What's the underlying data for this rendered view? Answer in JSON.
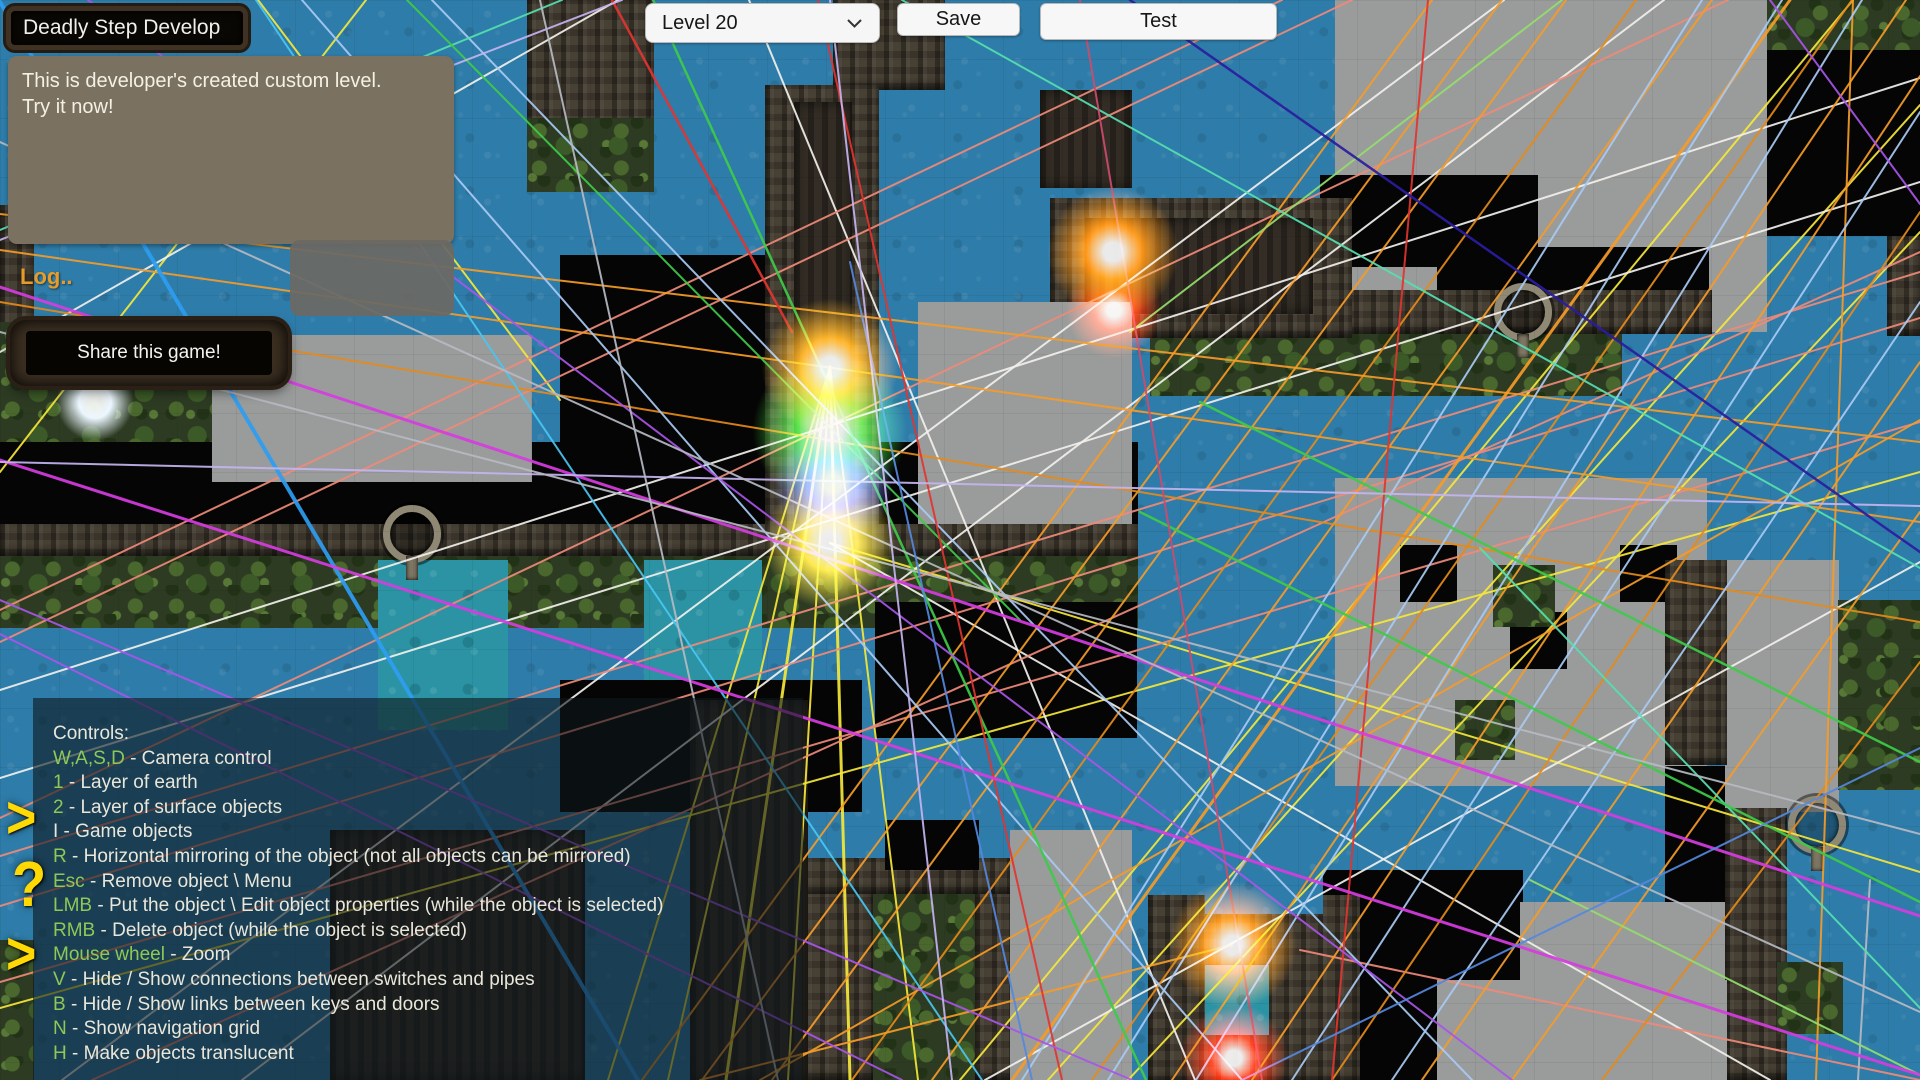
{
  "ui": {
    "title": "Deadly Step Develop",
    "description_line1": "This is developer's created custom level.",
    "description_line2": "Try it now!",
    "log_label": "Log..",
    "share_label": "Share this game!",
    "level_select": {
      "value": "Level 20"
    },
    "save_label": "Save",
    "test_label": "Test",
    "colors": {
      "key_green": "#8dc957",
      "key_white": "#e9e6da",
      "log_orange": "#e79b28",
      "glyph_yellow": "#ffd903",
      "panel_bg": "rgba(14,22,27,0.60)",
      "desc_bg": "#7a7160"
    },
    "side_glyphs": [
      {
        "glyph": ">",
        "x": 6,
        "y": 792,
        "size": 52,
        "name": "arrow-right-icon"
      },
      {
        "glyph": "?",
        "x": 12,
        "y": 856,
        "size": 56,
        "name": "question-icon"
      },
      {
        "glyph": ">",
        "x": 6,
        "y": 928,
        "size": 52,
        "name": "arrow-right-icon"
      }
    ],
    "controls_panel": {
      "heading": "Controls:",
      "items": [
        {
          "key": "W,A,S,D",
          "key_color": "g",
          "desc": " - Camera control"
        },
        {
          "key": "1",
          "key_color": "g",
          "desc": " - Layer of earth"
        },
        {
          "key": "2",
          "key_color": "g",
          "desc": " - Layer of surface objects"
        },
        {
          "key": "I",
          "key_color": "w",
          "desc": " - Game objects"
        },
        {
          "key": "R",
          "key_color": "g",
          "desc": " - Horizontal mirroring of the object (not all objects can be mirrored)"
        },
        {
          "key": "Esc",
          "key_color": "g",
          "desc": " - Remove object \\ Menu"
        },
        {
          "key": "LMB",
          "key_color": "g",
          "desc": " - Put the object \\ Edit object properties (while the object is selected)"
        },
        {
          "key": "RMB",
          "key_color": "g",
          "desc": " - Delete object (while the object is selected)"
        },
        {
          "key": "Mouse wheel",
          "key_color": "g",
          "desc": " - Zoom"
        },
        {
          "key": "V",
          "key_color": "g",
          "desc": " - Hide / Show connections between switches and pipes"
        },
        {
          "key": "B",
          "key_color": "g",
          "desc": " - Hide / Show links between keys and doors"
        },
        {
          "key": "N",
          "key_color": "g",
          "desc": " - Show navigation grid"
        },
        {
          "key": "H",
          "key_color": "g",
          "desc": " - Make objects translucent"
        }
      ]
    }
  },
  "map": {
    "palette": {
      "or": "#f59b28",
      "or2": "#e58a1a",
      "yl": "#f5e73a",
      "wh": "#f2f0ec",
      "sl": "#ef8a78",
      "lb": "#a8caf4",
      "cy": "#49c6f2",
      "te": "#56e0b0",
      "gr": "#3ecb49",
      "lg": "#93de6c",
      "rd": "#e23430",
      "cr": "#cf4a6e",
      "pu": "#a855e8",
      "ma": "#d63ce0",
      "lv": "#c4b4f0",
      "nv": "#2a1c9e",
      "gy": "#b6bac2",
      "bl": "#2e9df2",
      "db": "#5588dd"
    },
    "regions": [
      [
        527,
        0,
        127,
        132,
        "stone"
      ],
      [
        527,
        118,
        127,
        74,
        "jungle"
      ],
      [
        833,
        0,
        112,
        90,
        "stone"
      ],
      [
        1040,
        90,
        92,
        98,
        "stonedark"
      ],
      [
        1335,
        0,
        432,
        332,
        "gray"
      ],
      [
        1767,
        0,
        155,
        50,
        "jungle"
      ],
      [
        1767,
        50,
        155,
        186,
        "void"
      ],
      [
        1887,
        236,
        33,
        100,
        "stone"
      ],
      [
        1320,
        175,
        218,
        92,
        "void"
      ],
      [
        1437,
        247,
        272,
        46,
        "void"
      ],
      [
        1150,
        290,
        562,
        44,
        "stone"
      ],
      [
        1150,
        334,
        472,
        62,
        "jungle"
      ],
      [
        1235,
        396,
        385,
        82,
        "water"
      ],
      [
        1050,
        198,
        302,
        140,
        "stone"
      ],
      [
        1085,
        218,
        228,
        96,
        "stonedark"
      ],
      [
        733,
        300,
        129,
        50,
        "pool"
      ],
      [
        0,
        205,
        34,
        140,
        "stone"
      ],
      [
        0,
        322,
        232,
        122,
        "jungle"
      ],
      [
        0,
        442,
        1138,
        84,
        "void"
      ],
      [
        560,
        255,
        212,
        272,
        "void"
      ],
      [
        212,
        335,
        320,
        147,
        "gray"
      ],
      [
        765,
        85,
        114,
        468,
        "stone"
      ],
      [
        794,
        102,
        58,
        442,
        "stonedark"
      ],
      [
        918,
        302,
        214,
        300,
        "gray"
      ],
      [
        0,
        524,
        1138,
        32,
        "stone"
      ],
      [
        0,
        556,
        1138,
        72,
        "jungle"
      ],
      [
        378,
        560,
        130,
        170,
        "pool"
      ],
      [
        644,
        560,
        118,
        130,
        "pool"
      ],
      [
        875,
        602,
        262,
        136,
        "void"
      ],
      [
        560,
        680,
        302,
        132,
        "void"
      ],
      [
        1335,
        478,
        372,
        308,
        "gray"
      ],
      [
        1400,
        545,
        57,
        57,
        "void"
      ],
      [
        1510,
        612,
        57,
        57,
        "void"
      ],
      [
        1620,
        545,
        57,
        57,
        "void"
      ],
      [
        1455,
        700,
        60,
        60,
        "jungle"
      ],
      [
        1725,
        560,
        114,
        252,
        "gray"
      ],
      [
        1665,
        560,
        62,
        205,
        "stone"
      ],
      [
        1665,
        766,
        60,
        176,
        "void"
      ],
      [
        1493,
        565,
        62,
        62,
        "jungle"
      ],
      [
        1838,
        600,
        82,
        190,
        "jungle"
      ],
      [
        1725,
        808,
        62,
        272,
        "stone"
      ],
      [
        1777,
        962,
        66,
        72,
        "jungle"
      ],
      [
        1323,
        870,
        200,
        110,
        "void"
      ],
      [
        1323,
        870,
        115,
        210,
        "void"
      ],
      [
        1437,
        980,
        290,
        100,
        "gray"
      ],
      [
        1520,
        902,
        205,
        178,
        "gray"
      ],
      [
        1148,
        895,
        212,
        188,
        "stone"
      ],
      [
        1205,
        850,
        118,
        64,
        "water"
      ],
      [
        1205,
        965,
        64,
        70,
        "pool"
      ],
      [
        803,
        858,
        232,
        36,
        "stone"
      ],
      [
        803,
        894,
        70,
        186,
        "stone"
      ],
      [
        975,
        894,
        60,
        186,
        "stone"
      ],
      [
        873,
        894,
        102,
        186,
        "jungle"
      ],
      [
        1010,
        830,
        122,
        250,
        "gray"
      ],
      [
        885,
        820,
        94,
        50,
        "void"
      ],
      [
        330,
        830,
        255,
        250,
        "stonedark"
      ],
      [
        690,
        700,
        118,
        380,
        "stonedark"
      ],
      [
        0,
        940,
        34,
        140,
        "jungle"
      ],
      [
        383,
        505,
        44,
        44,
        "ring"
      ],
      [
        1494,
        283,
        44,
        44,
        "ring"
      ],
      [
        1788,
        796,
        44,
        44,
        "ring"
      ]
    ],
    "glows": [
      [
        830,
        367,
        60,
        "#ffaa10"
      ],
      [
        830,
        430,
        68,
        "#3fe03c"
      ],
      [
        833,
        484,
        52,
        "#7d88ff"
      ],
      [
        830,
        543,
        58,
        "#ffe434"
      ],
      [
        1113,
        252,
        58,
        "#ff8a00"
      ],
      [
        1114,
        310,
        42,
        "#ff3000"
      ],
      [
        1233,
        945,
        56,
        "#ff8a00"
      ],
      [
        1234,
        1058,
        48,
        "#ff2000"
      ],
      [
        95,
        402,
        34,
        "#e8f4ff"
      ]
    ],
    "lines": [
      [
        830,
        367,
        608,
        1080,
        "yl",
        2
      ],
      [
        830,
        367,
        668,
        1080,
        "yl",
        2
      ],
      [
        830,
        367,
        726,
        1080,
        "yl",
        3
      ],
      [
        830,
        367,
        788,
        1080,
        "yl",
        2
      ],
      [
        830,
        367,
        850,
        1080,
        "yl",
        3
      ],
      [
        830,
        367,
        918,
        1080,
        "yl",
        2
      ],
      [
        258,
        0,
        560,
        400,
        "yl",
        2
      ],
      [
        0,
        472,
        366,
        0,
        "yl",
        2
      ],
      [
        960,
        1080,
        1853,
        0,
        "yl",
        2
      ],
      [
        1048,
        1080,
        1920,
        105,
        "yl",
        2
      ],
      [
        1128,
        1080,
        1920,
        232,
        "yl",
        2
      ],
      [
        0,
        1008,
        1920,
        472,
        "yl",
        2
      ],
      [
        830,
        543,
        1920,
        872,
        "yl",
        2
      ],
      [
        0,
        690,
        1920,
        78,
        "wh",
        2
      ],
      [
        0,
        778,
        1920,
        182,
        "wh",
        2
      ],
      [
        62,
        1080,
        1504,
        0,
        "wh",
        2
      ],
      [
        242,
        1080,
        1664,
        0,
        "wh",
        2
      ],
      [
        830,
        543,
        1770,
        1080,
        "wh",
        2
      ],
      [
        0,
        352,
        618,
        0,
        "wh",
        2
      ],
      [
        985,
        1080,
        1920,
        562,
        "wh",
        2
      ],
      [
        749,
        0,
        1195,
        1080,
        "wh",
        2
      ],
      [
        0,
        906,
        1920,
        318,
        "sl",
        2
      ],
      [
        0,
        856,
        1920,
        272,
        "sl",
        2
      ],
      [
        0,
        818,
        1728,
        0,
        "sl",
        2
      ],
      [
        0,
        642,
        1352,
        0,
        "sl",
        2
      ],
      [
        0,
        610,
        1282,
        0,
        "sl",
        2
      ],
      [
        92,
        1080,
        1920,
        252,
        "sl",
        2
      ],
      [
        0,
        982,
        1920,
        422,
        "sl",
        2
      ],
      [
        1300,
        950,
        1920,
        1080,
        "sl",
        2
      ],
      [
        642,
        1080,
        1432,
        0,
        "or",
        2
      ],
      [
        702,
        1080,
        1502,
        0,
        "or",
        2
      ],
      [
        772,
        1080,
        1566,
        0,
        "or",
        2
      ],
      [
        852,
        1080,
        1636,
        0,
        "or2",
        2
      ],
      [
        932,
        1080,
        1712,
        0,
        "or",
        2
      ],
      [
        1012,
        1080,
        1790,
        0,
        "or",
        3
      ],
      [
        1092,
        1080,
        1852,
        0,
        "or2",
        2
      ],
      [
        1172,
        1080,
        1906,
        0,
        "or",
        2
      ],
      [
        1252,
        1080,
        1920,
        76,
        "or",
        2
      ],
      [
        1332,
        1080,
        1920,
        212,
        "or2",
        2
      ],
      [
        1422,
        1080,
        1920,
        362,
        "or",
        2
      ],
      [
        1512,
        1080,
        1920,
        512,
        "or",
        2
      ],
      [
        1602,
        1080,
        1920,
        662,
        "or2",
        2
      ],
      [
        1853,
        0,
        1816,
        1080,
        "or",
        2
      ],
      [
        0,
        250,
        1920,
        522,
        "or",
        2
      ],
      [
        0,
        302,
        1920,
        622,
        "or2",
        2
      ],
      [
        0,
        214,
        1920,
        442,
        "or",
        2
      ],
      [
        760,
        1080,
        1920,
        420,
        "or",
        2
      ],
      [
        700,
        1080,
        1232,
        945,
        "or",
        2
      ],
      [
        1022,
        1080,
        1702,
        0,
        "lb",
        2
      ],
      [
        1108,
        1080,
        1782,
        0,
        "lb",
        2
      ],
      [
        1196,
        1080,
        1862,
        0,
        "lb",
        2
      ],
      [
        1292,
        1080,
        1920,
        112,
        "lb",
        2
      ],
      [
        1392,
        1080,
        1920,
        302,
        "lb",
        2
      ],
      [
        302,
        0,
        1242,
        1080,
        "lb",
        2
      ],
      [
        432,
        0,
        1472,
        1080,
        "lb",
        2
      ],
      [
        1870,
        880,
        1858,
        1080,
        "gy",
        2
      ],
      [
        0,
        2,
        638,
        1080,
        "bl",
        4
      ],
      [
        256,
        0,
        982,
        1080,
        "cy",
        2
      ],
      [
        902,
        0,
        1920,
        568,
        "te",
        2
      ],
      [
        1480,
        548,
        1920,
        1008,
        "te",
        2
      ],
      [
        0,
        230,
        562,
        0,
        "te",
        2
      ],
      [
        653,
        0,
        1146,
        1080,
        "gr",
        2.5
      ],
      [
        1200,
        402,
        1920,
        762,
        "gr",
        2.5
      ],
      [
        1140,
        512,
        1920,
        902,
        "gr",
        2.5
      ],
      [
        1130,
        332,
        1562,
        0,
        "lg",
        2
      ],
      [
        407,
        0,
        1020,
        620,
        "gr",
        2
      ],
      [
        1530,
        880,
        1920,
        1075,
        "lg",
        2
      ],
      [
        818,
        0,
        1062,
        1080,
        "rd",
        2
      ],
      [
        1428,
        0,
        1332,
        1080,
        "rd",
        2
      ],
      [
        612,
        0,
        792,
        332,
        "rd",
        2.5
      ],
      [
        1080,
        0,
        1262,
        1080,
        "cr",
        2
      ],
      [
        0,
        600,
        1132,
        1080,
        "pu",
        2
      ],
      [
        0,
        634,
        902,
        1080,
        "pu",
        2
      ],
      [
        88,
        0,
        1512,
        1080,
        "pu",
        2
      ],
      [
        1770,
        0,
        1920,
        204,
        "pu",
        2
      ],
      [
        0,
        287,
        1920,
        916,
        "ma",
        3
      ],
      [
        0,
        460,
        1920,
        1075,
        "ma",
        3
      ],
      [
        0,
        462,
        1920,
        506,
        "lv",
        2
      ],
      [
        830,
        0,
        952,
        1080,
        "lv",
        2
      ],
      [
        0,
        240,
        622,
        0,
        "lv",
        2
      ],
      [
        1130,
        0,
        1920,
        552,
        "nv",
        2.5
      ],
      [
        0,
        332,
        1920,
        834,
        "gy",
        2
      ],
      [
        540,
        0,
        778,
        1080,
        "gy",
        2
      ],
      [
        0,
        142,
        1920,
        1012,
        "gy",
        2
      ],
      [
        1242,
        1080,
        1920,
        748,
        "db",
        2
      ],
      [
        850,
        262,
        1032,
        1080,
        "db",
        2
      ]
    ]
  }
}
